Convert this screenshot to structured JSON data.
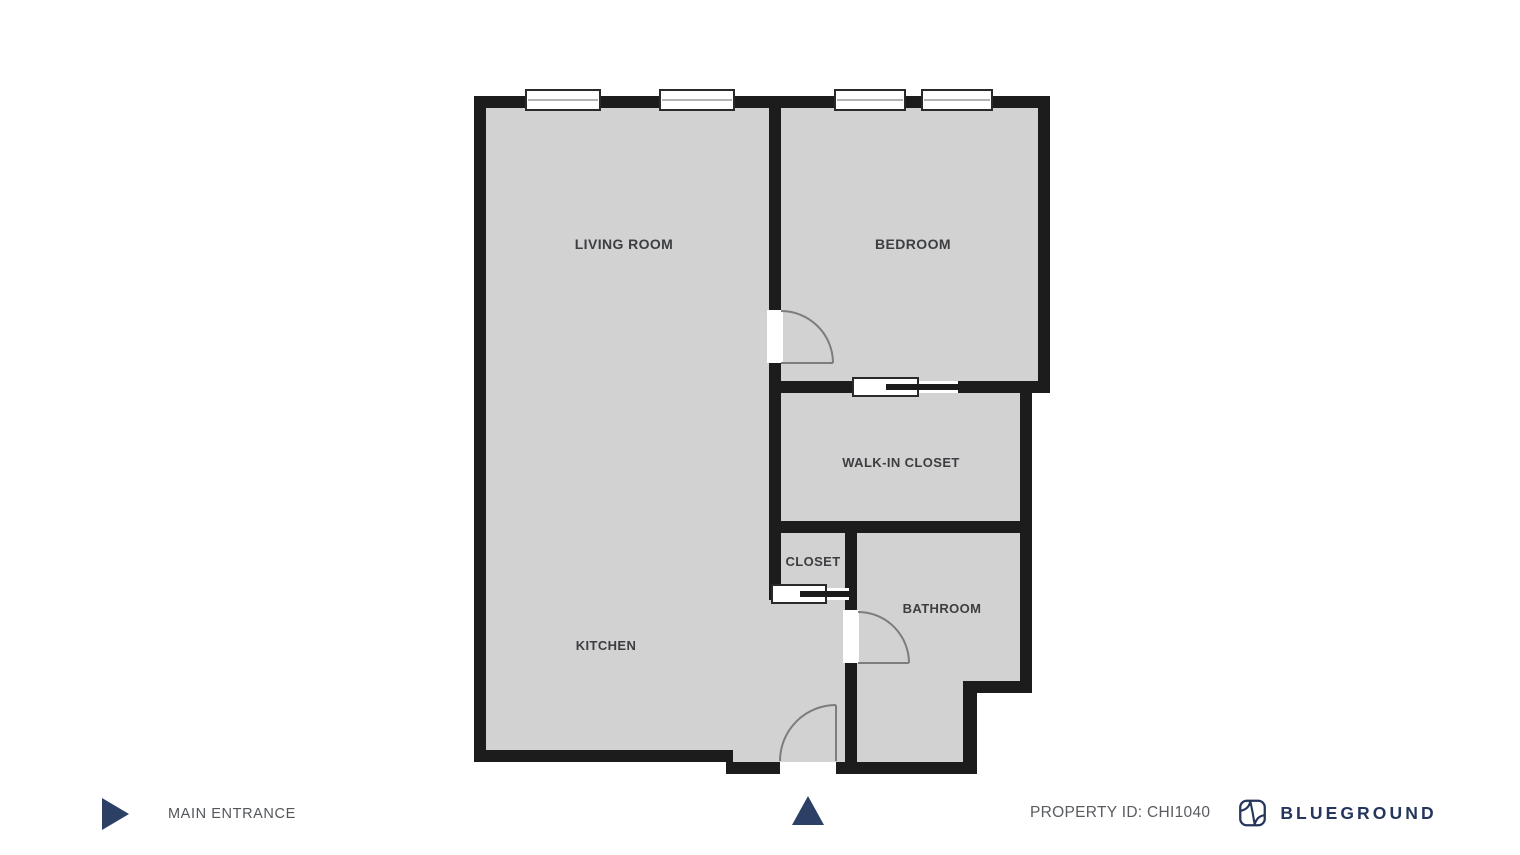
{
  "page": {
    "type": "apartment-floor-plan",
    "background": "#ffffff"
  },
  "floor_plan": {
    "rooms": [
      {
        "label": "LIVING ROOM"
      },
      {
        "label": "BEDROOM"
      },
      {
        "label": "WALK-IN CLOSET"
      },
      {
        "label": "CLOSET"
      },
      {
        "label": "BATHROOM"
      },
      {
        "label": "KITCHEN"
      }
    ],
    "entrance_marker_icon": "triangle-up",
    "colors": {
      "floor_fill": "#d2d2d2",
      "wall": "#1c1c1c",
      "door_arc": "#7d7d7d",
      "room_label": "#3c3e41",
      "accent_navy": "#2c4066",
      "brand_navy": "#25355c"
    }
  },
  "legend": {
    "icon": "triangle-right-icon",
    "main_entrance_label": "MAIN ENTRANCE"
  },
  "footer": {
    "property_id_label": "PROPERTY ID: CHI1040",
    "brand_logo_icon": "blueground-mark",
    "brand_name": "BLUEGROUND"
  }
}
